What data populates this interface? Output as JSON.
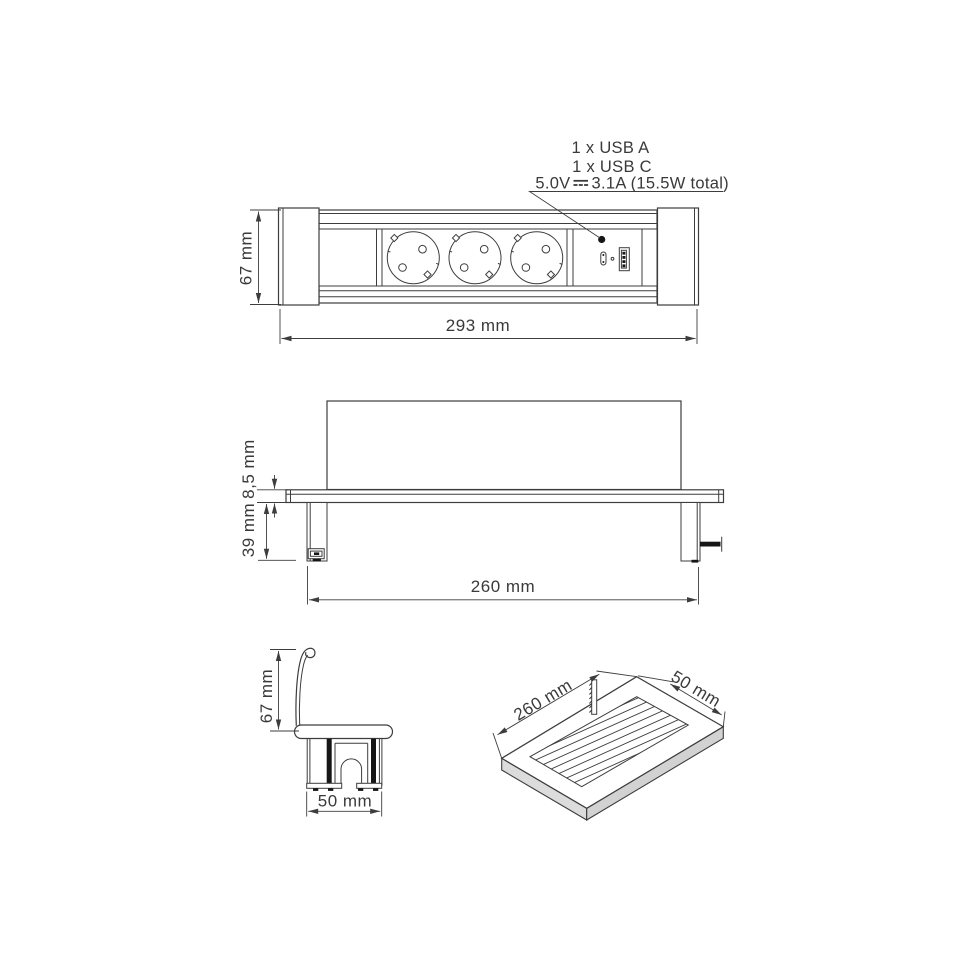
{
  "drawing": {
    "front_view": {
      "height_dim": "67 mm",
      "width_dim": "293 mm",
      "annotation": {
        "line1": "1 x USB  A",
        "line2": "1 x USB C",
        "power_prefix": "5.0V",
        "power_suffix": "3.1A (15.5W total)"
      }
    },
    "section_view": {
      "flange_dim": "8,5 mm",
      "depth_dim": "39 mm",
      "width_dim": "260 mm"
    },
    "profile_view": {
      "height_dim": "67 mm",
      "width_dim": "50 mm"
    },
    "cutout_view": {
      "length_dim": "260 mm",
      "width_dim": "50 mm"
    }
  },
  "colors": {
    "line": "#3d3d3d",
    "black_fill": "#161616",
    "slab_side_left": "#dcdcdc",
    "slab_side_right": "#d2d2d2",
    "background": "#ffffff"
  }
}
